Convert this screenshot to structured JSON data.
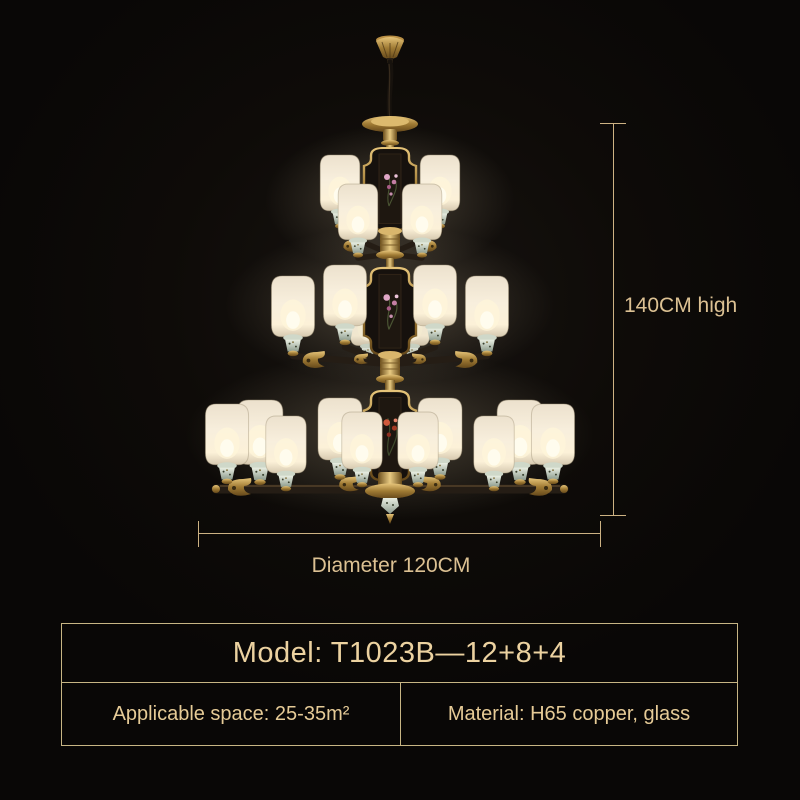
{
  "page": {
    "background": "#0d0a08",
    "accent_gold": "#cdb283",
    "label_gold": "#dcc193",
    "table_border_gold": "#c7b584",
    "table_text_gold": "#ecd2a0"
  },
  "product": {
    "illustration": "three-tier copper chandelier with cream glass cylinder shades",
    "lamp_layout": "12+8+4"
  },
  "dimensions": {
    "height_label": "140CM high",
    "diameter_label": "Diameter 120CM"
  },
  "spec_table": {
    "model_label": "Model: T1023B—12+8+4",
    "cells": [
      {
        "label": "Applicable space: 25-35m²"
      },
      {
        "label": "Material: H65 copper, glass"
      }
    ]
  }
}
